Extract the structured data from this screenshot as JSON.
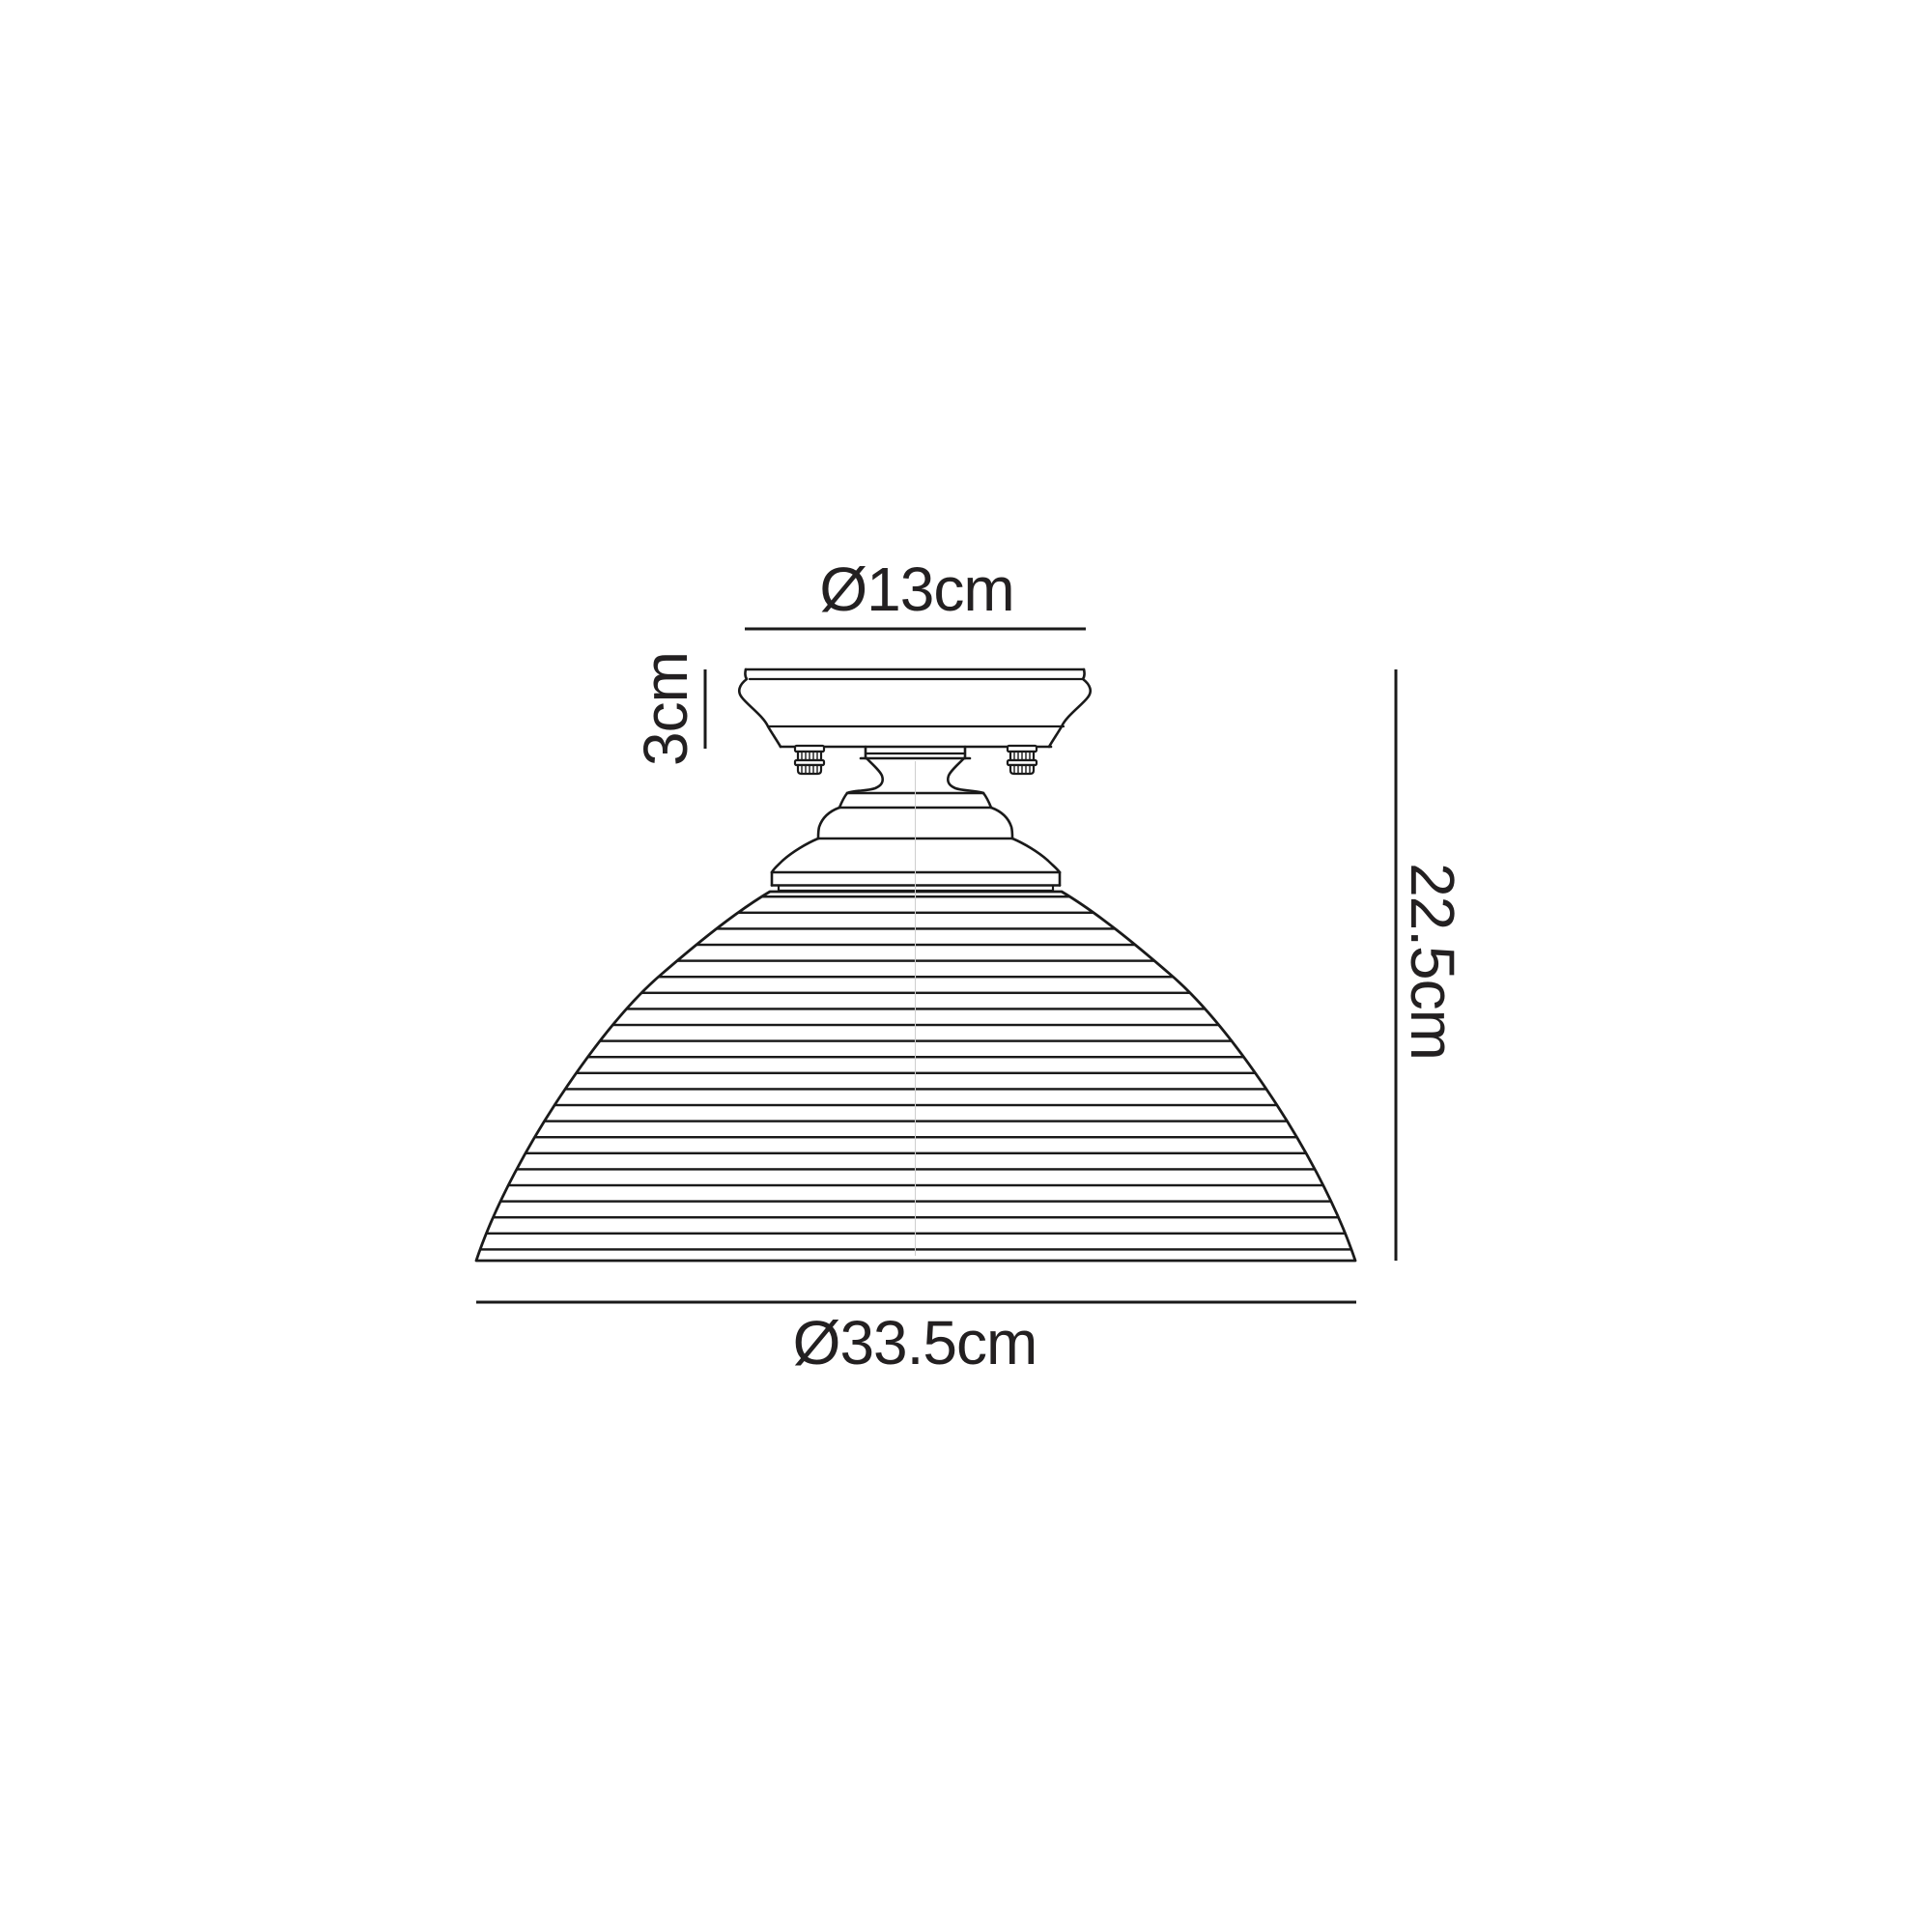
{
  "page": {
    "background_color": "#ffffff"
  },
  "drawing": {
    "line_color": "#1a1a1a",
    "text_color": "#232021",
    "centerline_color": "#cfcfcf"
  },
  "labels": {
    "canopy_diameter": "Ø13cm",
    "canopy_height": "3cm",
    "total_height": "22.5cm",
    "shade_diameter": "Ø33.5cm"
  }
}
